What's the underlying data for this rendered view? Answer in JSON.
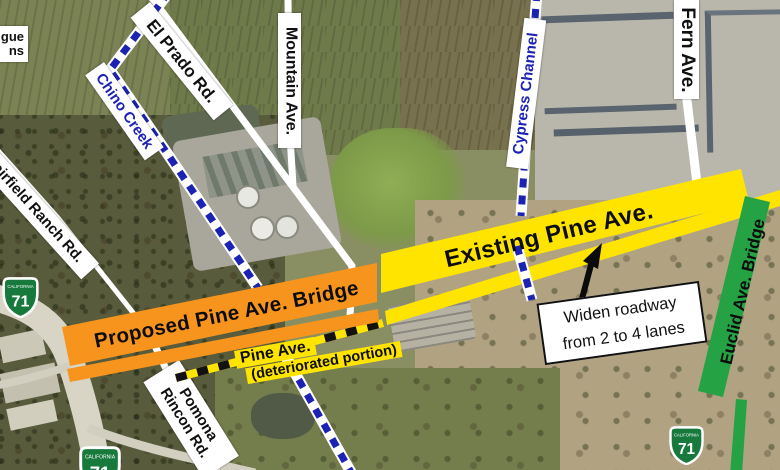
{
  "edge_label": {
    "line1": "gue",
    "line2": "ns"
  },
  "road_labels": {
    "el_prado": "El Prado Rd.",
    "mountain": "Mountain Ave.",
    "fern": "Fern Ave.",
    "fairfield": "Fairfield Ranch Rd.",
    "pomona_line1": "Pomona",
    "pomona_line2": "Rincon Rd."
  },
  "waterway_labels": {
    "chino": "Chino Creek",
    "cypress": "Cypress Channel"
  },
  "project_annotations": {
    "existing_band": "Existing Pine Ave.",
    "proposed_band": "Proposed Pine Ave. Bridge",
    "deteriorated_line1": "Pine Ave.",
    "deteriorated_line2": "(deteriorated portion)",
    "euclid_band": "Euclid Ave. Bridge",
    "callout_line1": "Widen roadway",
    "callout_line2": "from 2 to 4 lanes"
  },
  "route_shield": {
    "state": "CALIFORNIA",
    "route": "71"
  },
  "colors": {
    "existing_band_yellow": "#ffe400",
    "proposed_band_orange": "#f7941d",
    "euclid_band_green": "#25a244",
    "waterway_blue": "#1c23b4",
    "shield_green": "#17793c",
    "road_white": "#ffffff"
  }
}
